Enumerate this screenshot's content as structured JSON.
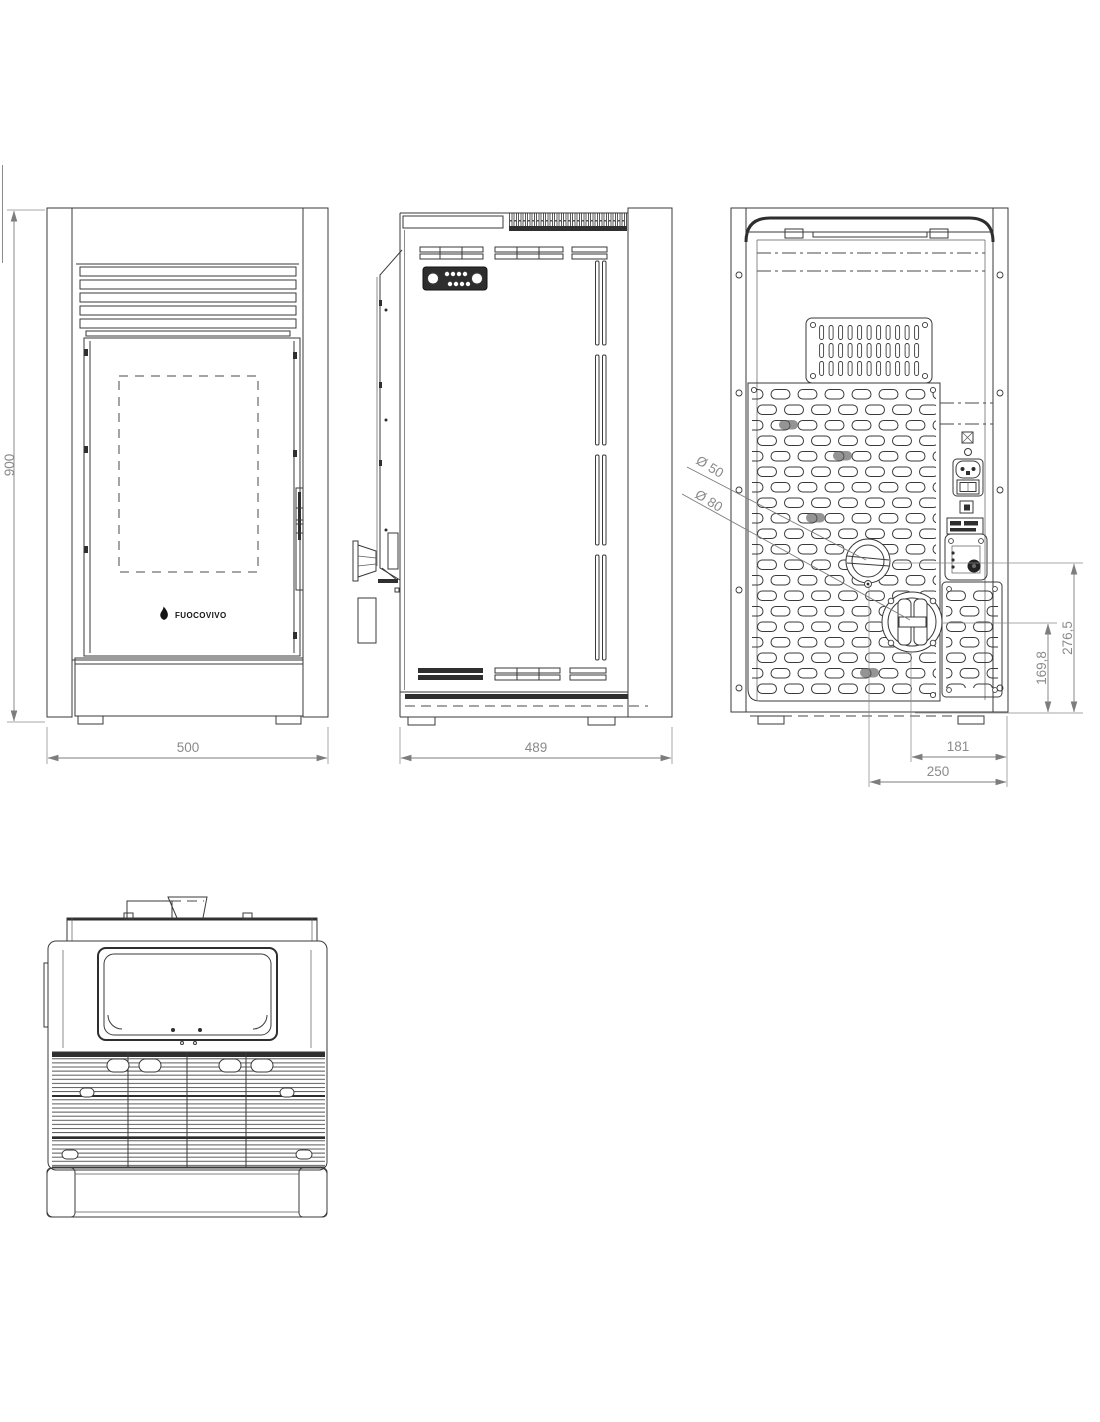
{
  "page": {
    "background_color": "#ffffff",
    "line_color": "#3a3a3a",
    "dimension_color": "#8a8a8a"
  },
  "branding": {
    "logo_text": "FUOCOVIVO"
  },
  "dimensions": {
    "overall_height": "900",
    "overall_width": "500",
    "overall_depth": "489",
    "air_intake_diameter": "Ø 50",
    "flue_diameter": "Ø 80",
    "air_intake_center_height": "276,5",
    "flue_center_height": "169,8",
    "flue_offset_from_side": "181",
    "air_intake_offset_from_side": "250"
  }
}
